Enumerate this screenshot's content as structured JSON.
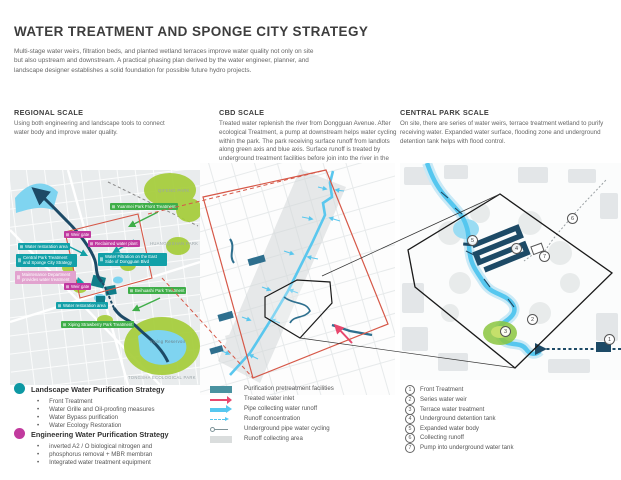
{
  "page": {
    "title": "WATER TREATMENT AND SPONGE CITY STRATEGY",
    "intro": "Multi-stage water weirs, filtration beds, and planted wetland terraces improve water quality not only on site but also upstream and downstream. A practical phasing plan derived by the water engineer, planner, and landscape designer establishes a solid foundation for possible future hydro projects."
  },
  "columns": [
    {
      "heading": "REGIONAL SCALE",
      "body": "Using both engineering and landscape tools to connect water body and improve water quality."
    },
    {
      "heading": "CBD SCALE",
      "body": "Treated water replenish the river from Dongguan Avenue. After ecological Treatment, a pump at downstream helps water cycling within the park. The park receiving surface runoff from landlots along green axis and blue axis. Surface runoff is treated by underground treatment facilities before join into the river in the park."
    },
    {
      "heading": "CENTRAL PARK SCALE",
      "body": "On site, there are series of water weirs, terrace treatment wetland to purify receiving water. Expanded water surface, flooding zone and underground detention tank helps with flood control."
    }
  ],
  "regional_map": {
    "labels": [
      {
        "text": "Yuanmei Park Front Treatment",
        "kind": "green"
      },
      {
        "text": "Weir gate",
        "kind": "magenta"
      },
      {
        "text": "Reclaimed water plant",
        "kind": "magenta"
      },
      {
        "text": "Water restoration area",
        "kind": "teal"
      },
      {
        "text": "Central Park Treatment and Sponge City Strategy",
        "kind": "teal"
      },
      {
        "text": "Water Filtration on the East Side of Dongguan Blvd",
        "kind": "teal"
      },
      {
        "text": "Maintenance Department provides water treatment",
        "kind": "pink"
      },
      {
        "text": "Weir gate",
        "kind": "magenta"
      },
      {
        "text": "Beihuashi Park Treatment",
        "kind": "green"
      },
      {
        "text": "Water restoration area",
        "kind": "teal"
      },
      {
        "text": "Xiping Strawberry Park Treatment",
        "kind": "green"
      }
    ],
    "places": [
      "QIFENG PARK",
      "HUANGQISHAN PARK",
      "Xiping Reservoir",
      "TONGSHA ECOLOGICAL PARK"
    ]
  },
  "central_map": {
    "markers": [
      {
        "n": "1"
      },
      {
        "n": "2"
      },
      {
        "n": "3"
      },
      {
        "n": "4"
      },
      {
        "n": "5"
      },
      {
        "n": "6"
      },
      {
        "n": "7"
      }
    ]
  },
  "legend_landscape": {
    "title": "Landscape Water Purification Strategy",
    "items": [
      "Front Treatment",
      "Water Grille and Oil-proofing measures",
      "Water Bypass purification",
      "Water Ecology Restoration"
    ]
  },
  "legend_engineering": {
    "title": "Engineering Water Purification Strategy",
    "items": [
      "inverted A2 / O biological nitrogen and",
      "phosphorus removal + MBR membran",
      "Integrated water treatment equipment"
    ]
  },
  "legend_symbols": {
    "items": [
      {
        "swatch": "facility-rect",
        "label": "Purification pretreatment facilities"
      },
      {
        "swatch": "red-arrow",
        "label": "Treated water inlet"
      },
      {
        "swatch": "blue-arrow",
        "label": "Pipe collecting water runoff"
      },
      {
        "swatch": "dashed-arrow",
        "label": "Runoff concentration"
      },
      {
        "swatch": "underground-pipe",
        "label": "Underground pipe water cycling"
      },
      {
        "swatch": "gray-rect",
        "label": "Runoff collecting area"
      }
    ]
  },
  "legend_numbered": {
    "items": [
      {
        "num": "1",
        "label": "Front Treatment"
      },
      {
        "num": "2",
        "label": "Series water weir"
      },
      {
        "num": "3",
        "label": "Terrace water treatment"
      },
      {
        "num": "4",
        "label": "Underground detention tank"
      },
      {
        "num": "5",
        "label": "Expanded water body"
      },
      {
        "num": "6",
        "label": "Collecting runoff"
      },
      {
        "num": "7",
        "label": "Pump into underground water tank"
      }
    ]
  },
  "colors": {
    "teal": "#12a0a8",
    "magenta": "#c0399f",
    "green": "#3fae49",
    "river_blue": "#56c7ef",
    "navy": "#1d4a66",
    "red_outline": "#d65848",
    "red_arrow": "#e8486e",
    "park_green": "#a5cd39",
    "map_gray": "#e9eced"
  }
}
